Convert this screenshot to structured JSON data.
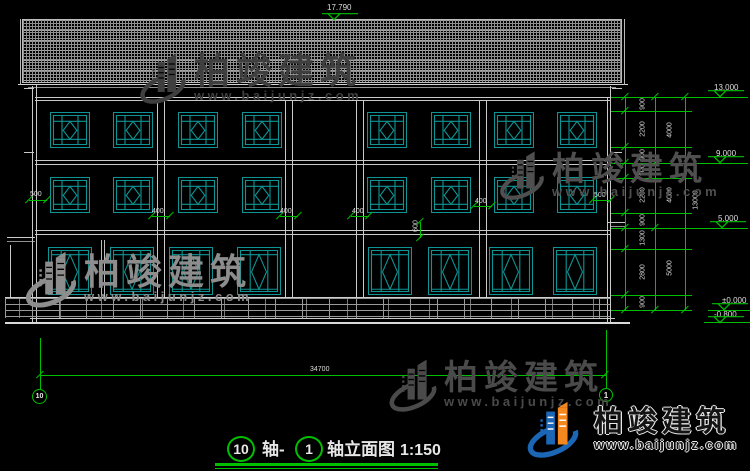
{
  "drawing": {
    "ridge_level": "17.790",
    "levels": {
      "eave": "13.000",
      "floor3": "9.000",
      "floor2": "5.000",
      "ground": "±0.000",
      "below": "-0.800"
    },
    "chain_inner": [
      "900",
      "2200",
      "900",
      "900",
      "2200",
      "900",
      "1300",
      "2800",
      "900"
    ],
    "chain_mid": [
      "4000",
      "4000",
      "5000"
    ],
    "chain_outer": "13000",
    "facade": {
      "left_wall": "500",
      "col1": "400",
      "col2": "400",
      "col3": "400",
      "col4": "400",
      "right_wall": "500",
      "mid_sill": "600"
    },
    "total_width": "34700",
    "axes": {
      "left": "10",
      "right": "1"
    },
    "title": {
      "axis_left": "10",
      "joiner": "轴-",
      "axis_right": "1",
      "name": "轴立面图",
      "scale": "1:150"
    }
  },
  "watermark": {
    "brand": "柏竣建筑",
    "url": "www.baijunjz.com"
  },
  "logo": {
    "brand": "柏竣建筑",
    "url": "www.baijunjz.com"
  },
  "colors": {
    "dimension_green": "#00bf00",
    "window_teal": "#0e9494",
    "line_white": "#c9c9c9",
    "logo_blue": "#1b66b5",
    "logo_orange": "#f5871f"
  }
}
